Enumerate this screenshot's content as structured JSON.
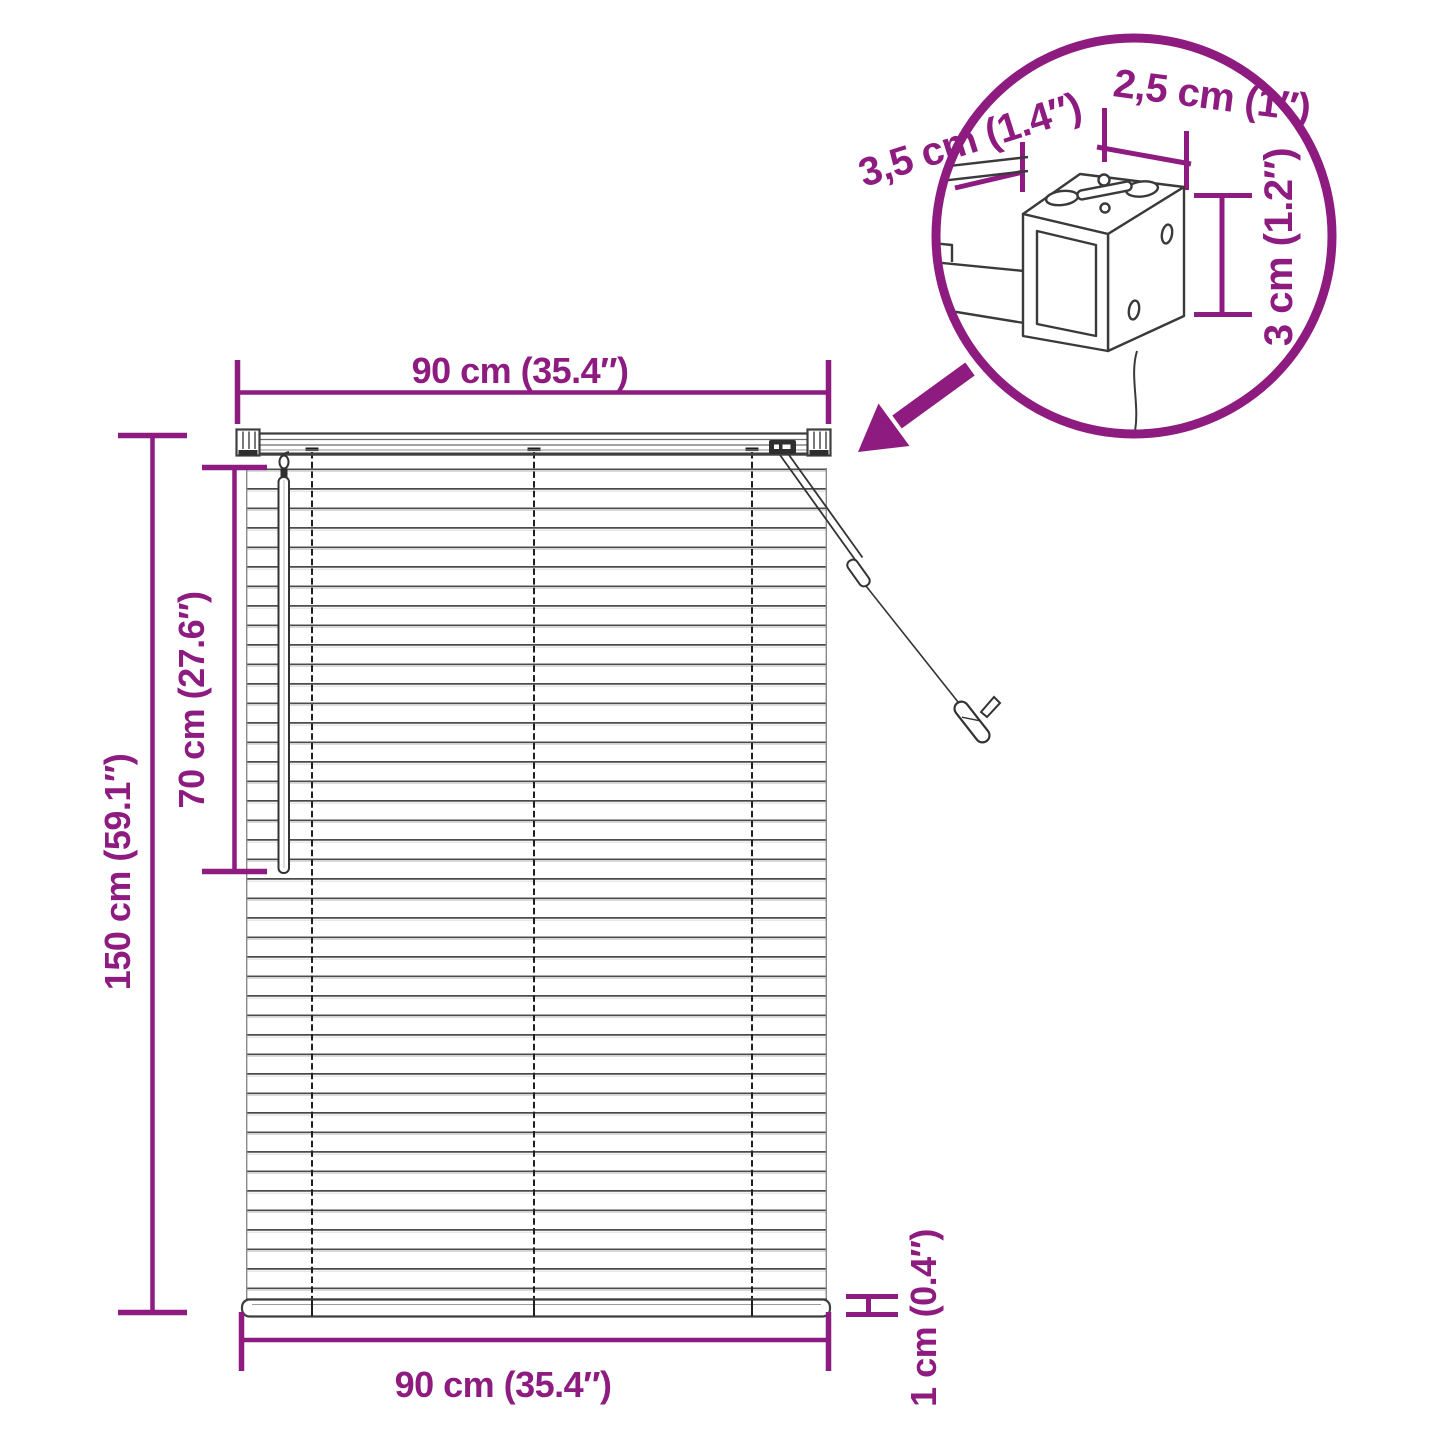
{
  "colors": {
    "accent": "#8E1B80",
    "line": "#3F3F3F"
  },
  "dimensions": {
    "top_width": "90 cm (35.4″)",
    "overall_height": "150 cm (59.1″)",
    "wand_length": "70 cm (27.6″)",
    "bottom_width": "90 cm (35.4″)",
    "bottom_rail_height": "1 cm (0.4″)",
    "headrail_depth": "3,5 cm (1.4″)",
    "headrail_width": "2,5 cm (1″)",
    "headrail_height": "3 cm (1.2″)"
  }
}
